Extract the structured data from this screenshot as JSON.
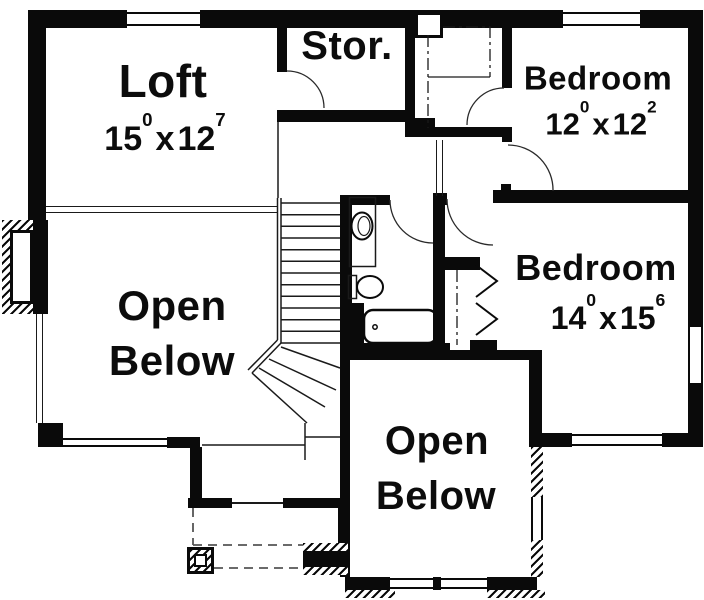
{
  "document": {
    "type": "floor-plan",
    "floor": "upper-floor"
  },
  "colors": {
    "wall": "#0a0a0a",
    "background": "#ffffff",
    "line": "#1a1a1a"
  },
  "rooms": {
    "loft": {
      "label": "Loft",
      "dim": {
        "a": "15",
        "a_sup": "0",
        "sep": "x",
        "b": "12",
        "b_sup": "7"
      }
    },
    "storage": {
      "label": "Stor."
    },
    "bedroom1": {
      "label": "Bedroom",
      "dim": {
        "a": "12",
        "a_sup": "0",
        "sep": "x",
        "b": "12",
        "b_sup": "2"
      }
    },
    "bedroom2": {
      "label": "Bedroom",
      "dim": {
        "a": "14",
        "a_sup": "0",
        "sep": "x",
        "b": "15",
        "b_sup": "6"
      }
    },
    "open_below_left": {
      "label_line1": "Open",
      "label_line2": "Below"
    },
    "open_below_bottom": {
      "label_line1": "Open",
      "label_line2": "Below"
    }
  },
  "elements": {
    "fixtures": [
      "sink",
      "toilet",
      "bathtub"
    ],
    "stairs": "winder-stairs",
    "closets": [
      "bedroom1-closet-with-rod-and-shelf",
      "bedroom2-closet-bifold"
    ],
    "chimney": "fireplace-chase",
    "porch_posts": 2,
    "doors": [
      "storage-door",
      "closet-door",
      "bedroom1-door",
      "bedroom2-door",
      "bathroom-door"
    ]
  }
}
